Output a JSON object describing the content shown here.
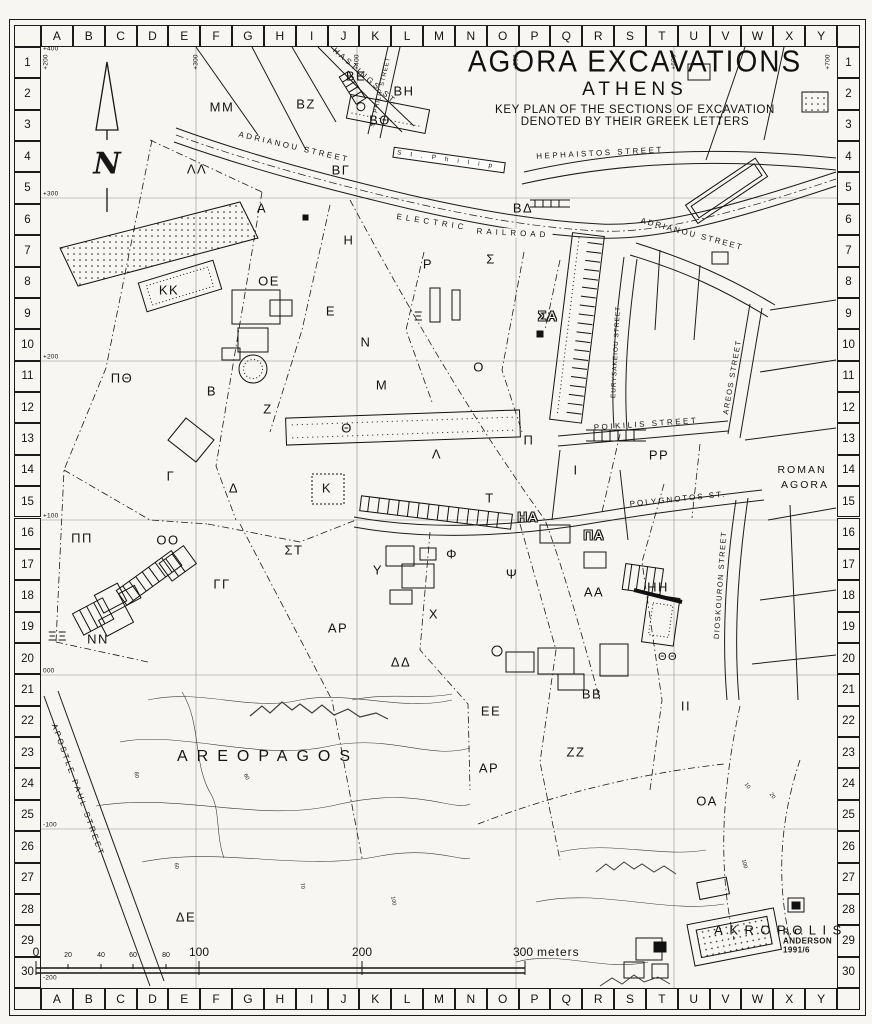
{
  "title": {
    "line1": "AGORA EXCAVATIONS",
    "line2": "ATHENS",
    "line3": "KEY PLAN OF THE SECTIONS OF EXCAVATION",
    "line4": "DENOTED BY THEIR GREEK LETTERS"
  },
  "credits": "R. C. ANDERSON   1991/6",
  "compass": {
    "label": "N"
  },
  "grid": {
    "columns": [
      "A",
      "B",
      "C",
      "D",
      "E",
      "F",
      "G",
      "H",
      "I",
      "J",
      "K",
      "L",
      "M",
      "N",
      "O",
      "P",
      "Q",
      "R",
      "S",
      "T",
      "U",
      "V",
      "W",
      "X",
      "Y"
    ],
    "rows": [
      "1",
      "2",
      "3",
      "4",
      "5",
      "6",
      "7",
      "8",
      "9",
      "10",
      "11",
      "12",
      "13",
      "14",
      "15",
      "16",
      "17",
      "18",
      "19",
      "20",
      "21",
      "22",
      "23",
      "24",
      "25",
      "26",
      "27",
      "28",
      "29",
      "30"
    ]
  },
  "coordinates": {
    "top": [
      {
        "label": "+200",
        "x": 46
      },
      {
        "label": "+300",
        "x": 196
      },
      {
        "label": "+400",
        "x": 357
      },
      {
        "label": "+500",
        "x": 516
      },
      {
        "label": "+600",
        "x": 674
      },
      {
        "label": "+700",
        "x": 828
      }
    ],
    "left": [
      {
        "label": "+400",
        "y": 53
      },
      {
        "label": "+300",
        "y": 198
      },
      {
        "label": "+200",
        "y": 361
      },
      {
        "label": "+100",
        "y": 520
      },
      {
        "label": "000",
        "y": 675
      },
      {
        "label": "-100",
        "y": 829
      },
      {
        "label": "-200",
        "y": 982
      }
    ]
  },
  "streets": [
    {
      "label": "HASTINGS ST.",
      "x": 366,
      "y": 77,
      "rot": 41
    },
    {
      "label": "ST. PHILIP STREET",
      "x": 381,
      "y": 92,
      "rot": -77,
      "fs": 6,
      "ls": 1
    },
    {
      "label": "ADRIANOU STREET",
      "x": 294,
      "y": 147,
      "rot": 13
    },
    {
      "label": "ELECTRIC",
      "x": 432,
      "y": 222,
      "rot": 9,
      "ls": 4,
      "bg": true
    },
    {
      "label": "RAILROAD",
      "x": 513,
      "y": 233,
      "rot": 3,
      "ls": 4,
      "bg": true
    },
    {
      "label": "HEPHAISTOS STREET",
      "x": 600,
      "y": 153,
      "rot": -3
    },
    {
      "label": "ADRIANOU STREET",
      "x": 692,
      "y": 234,
      "rot": 15,
      "ls": 2
    },
    {
      "label": "EURYSAKEIOU STREET",
      "x": 616,
      "y": 352,
      "rot": -87,
      "fs": 6.5,
      "ls": 1
    },
    {
      "label": "AREOS STREET",
      "x": 732,
      "y": 377,
      "rot": -80,
      "fs": 7.5,
      "ls": 1.5
    },
    {
      "label": "POIKILIS STREET",
      "x": 646,
      "y": 424,
      "rot": -4
    },
    {
      "label": "POLYGNOTOS ST.",
      "x": 678,
      "y": 499,
      "rot": -6,
      "ls": 2
    },
    {
      "label": "DIOSKOURON STREET",
      "x": 720,
      "y": 585,
      "rot": -86,
      "fs": 7.5,
      "ls": 1.5
    },
    {
      "label": "APOSTLE PAUL STREET",
      "x": 78,
      "y": 790,
      "rot": 70
    }
  ],
  "areas": [
    {
      "label": "AREOPAGOS",
      "x": 268,
      "y": 757
    },
    {
      "label": "AKROPOLIS",
      "x": 781,
      "y": 930,
      "fs": 13,
      "ls": 6.5
    },
    {
      "label": "ROMAN",
      "x": 802,
      "y": 470,
      "fs": 10.5,
      "ls": 2
    },
    {
      "label": "AGORA",
      "x": 805,
      "y": 485,
      "fs": 10.5,
      "ls": 2
    },
    {
      "label": "St.Philip",
      "x": 449,
      "y": 160,
      "rot": 8,
      "fs": 6.5,
      "boxed": true
    }
  ],
  "sections": [
    {
      "label": "ΒΕ",
      "x": 356,
      "y": 76
    },
    {
      "label": "ΒΗ",
      "x": 404,
      "y": 91
    },
    {
      "label": "ΒΖ",
      "x": 306,
      "y": 104
    },
    {
      "label": "ΒΘ",
      "x": 380,
      "y": 120
    },
    {
      "label": "ΜΜ",
      "x": 222,
      "y": 107
    },
    {
      "label": "ΛΛ",
      "x": 197,
      "y": 169
    },
    {
      "label": "ΒΓ",
      "x": 341,
      "y": 170
    },
    {
      "label": "Α",
      "x": 262,
      "y": 208
    },
    {
      "label": "ΒΔ",
      "x": 523,
      "y": 208
    },
    {
      "label": "Η",
      "x": 349,
      "y": 240
    },
    {
      "label": "Ρ",
      "x": 428,
      "y": 264
    },
    {
      "label": "Σ",
      "x": 491,
      "y": 259
    },
    {
      "label": "ΚΚ",
      "x": 169,
      "y": 290
    },
    {
      "label": "ΟΕ",
      "x": 269,
      "y": 281
    },
    {
      "label": "Ε",
      "x": 331,
      "y": 311
    },
    {
      "label": "Ξ",
      "x": 419,
      "y": 316
    },
    {
      "label": "Ν",
      "x": 366,
      "y": 342
    },
    {
      "label": "ΣΑ",
      "x": 548,
      "y": 316,
      "outline": true
    },
    {
      "label": "Ο",
      "x": 479,
      "y": 367
    },
    {
      "label": "ΠΘ",
      "x": 122,
      "y": 378
    },
    {
      "label": "Β",
      "x": 212,
      "y": 391
    },
    {
      "label": "Μ",
      "x": 382,
      "y": 385
    },
    {
      "label": "Ζ",
      "x": 268,
      "y": 409
    },
    {
      "label": "Θ",
      "x": 347,
      "y": 428
    },
    {
      "label": "Π",
      "x": 529,
      "y": 440
    },
    {
      "label": "Λ",
      "x": 437,
      "y": 454
    },
    {
      "label": "Γ",
      "x": 171,
      "y": 476
    },
    {
      "label": "Ι",
      "x": 576,
      "y": 470
    },
    {
      "label": "ΡΡ",
      "x": 659,
      "y": 455
    },
    {
      "label": "Δ",
      "x": 234,
      "y": 488
    },
    {
      "label": "Κ",
      "x": 327,
      "y": 488
    },
    {
      "label": "Τ",
      "x": 490,
      "y": 498
    },
    {
      "label": "ΗΑ",
      "x": 528,
      "y": 517,
      "outline": true
    },
    {
      "label": "ΠΑ",
      "x": 594,
      "y": 535,
      "outline": true
    },
    {
      "label": "ΠΠ",
      "x": 82,
      "y": 538
    },
    {
      "label": "ΟΟ",
      "x": 168,
      "y": 540
    },
    {
      "label": "ΣΤ",
      "x": 294,
      "y": 550
    },
    {
      "label": "Υ",
      "x": 378,
      "y": 570
    },
    {
      "label": "Φ",
      "x": 452,
      "y": 554
    },
    {
      "label": "Ψ",
      "x": 512,
      "y": 574
    },
    {
      "label": "ΓΓ",
      "x": 222,
      "y": 584
    },
    {
      "label": "ΑΑ",
      "x": 594,
      "y": 592
    },
    {
      "label": "ΗΗ",
      "x": 658,
      "y": 587
    },
    {
      "label": "Χ",
      "x": 434,
      "y": 614
    },
    {
      "label": "ΞΞ",
      "x": 58,
      "y": 636
    },
    {
      "label": "ΝΝ",
      "x": 98,
      "y": 639
    },
    {
      "label": "ΑΡ",
      "x": 338,
      "y": 628
    },
    {
      "label": "ΔΔ",
      "x": 401,
      "y": 662
    },
    {
      "label": "ΘΘ",
      "x": 668,
      "y": 657,
      "fs": 11
    },
    {
      "label": "ΒΒ",
      "x": 592,
      "y": 694
    },
    {
      "label": "ΙΙ",
      "x": 686,
      "y": 706
    },
    {
      "label": "ΕΕ",
      "x": 491,
      "y": 711
    },
    {
      "label": "ΖΖ",
      "x": 576,
      "y": 752
    },
    {
      "label": "ΑΡ",
      "x": 489,
      "y": 768
    },
    {
      "label": "ΟΑ",
      "x": 707,
      "y": 801
    },
    {
      "label": "ΔΕ",
      "x": 186,
      "y": 917
    }
  ],
  "contour_labels": [
    {
      "label": "60",
      "x": 176,
      "y": 866,
      "rot": 80
    },
    {
      "label": "70",
      "x": 302,
      "y": 886,
      "rot": 78
    },
    {
      "label": "100",
      "x": 393,
      "y": 901,
      "rot": 80
    },
    {
      "label": "60",
      "x": 246,
      "y": 777,
      "rot": 65
    },
    {
      "label": "80",
      "x": 136,
      "y": 775,
      "rot": 80
    },
    {
      "label": "100",
      "x": 744,
      "y": 864,
      "rot": 75
    },
    {
      "label": "10",
      "x": 747,
      "y": 786,
      "rot": 55
    },
    {
      "label": "20",
      "x": 772,
      "y": 796,
      "rot": 55
    }
  ],
  "scale_bar": {
    "ticks": [
      {
        "label": "0",
        "x": 36
      },
      {
        "label": "20",
        "x": 68,
        "small": true
      },
      {
        "label": "40",
        "x": 101,
        "small": true
      },
      {
        "label": "60",
        "x": 133,
        "small": true
      },
      {
        "label": "80",
        "x": 166,
        "small": true
      },
      {
        "label": "100",
        "x": 199
      },
      {
        "label": "200",
        "x": 362
      },
      {
        "label": "300",
        "x": 523
      }
    ],
    "unit_label": "meters"
  }
}
